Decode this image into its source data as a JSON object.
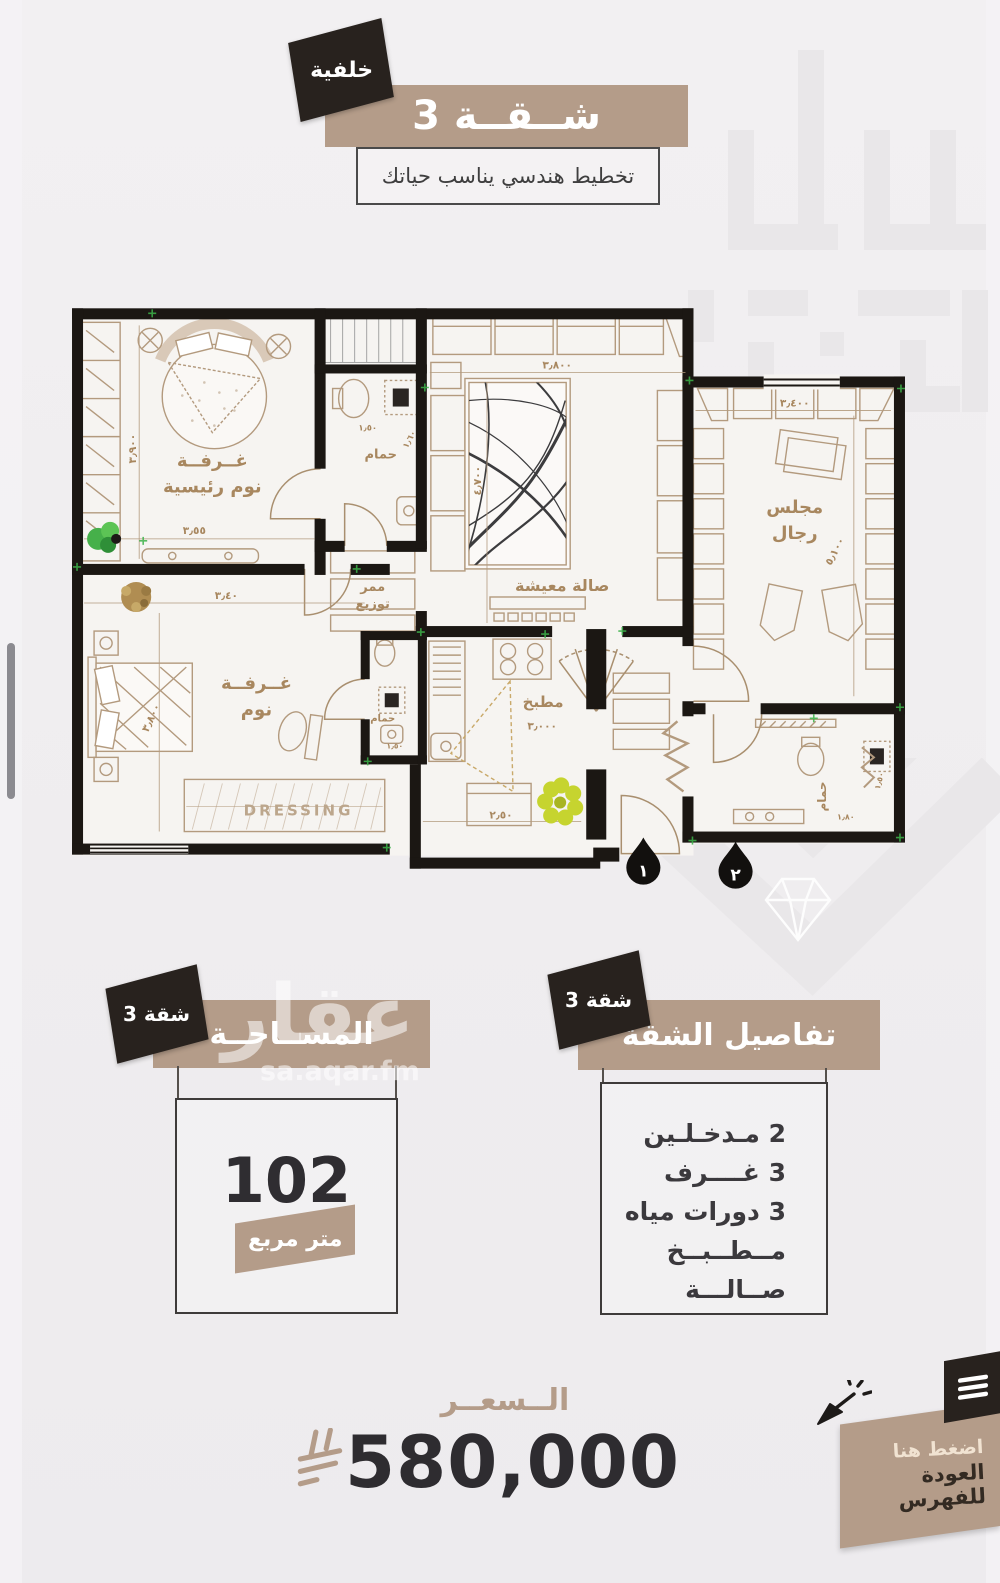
{
  "header": {
    "corner_badge": "خلفية",
    "title": "شــقــة 3",
    "subtitle": "تخطيط هندسي يناسب حياتك"
  },
  "floor_plan": {
    "master": {
      "line1": "غــرفــة",
      "line2": "نوم رئيسية",
      "dim_height": "٣٫٩٠٠",
      "dim_width": "٣٫٥٥"
    },
    "bath_top": {
      "label": "حمام",
      "dim1": "١٫٥٠",
      "dim2": "١٫٦٠"
    },
    "corridor": {
      "line1": "ممر",
      "line2": "توزيع"
    },
    "living": {
      "label": "صالة معيشة",
      "dim_width": "٣٫٨٠٠",
      "dim_height": "٤٫٧٠٠"
    },
    "majlis": {
      "line1": "مجلس",
      "line2": "رجال",
      "dim_width": "٣٫٤٠٠",
      "dim_height": "٥٫١٠٠"
    },
    "bedroom2": {
      "line1": "غــرفــة",
      "line2": "نوم",
      "dim_width": "٣٫٤٠",
      "dim_height": "٣٫٨٠٠"
    },
    "bath_small": {
      "label": "حمام",
      "dim1": "١٫٥٠"
    },
    "kitchen": {
      "label": "مطبخ",
      "dim1": "٣٫٠٠٠",
      "dim2": "٢٫٥٠"
    },
    "bath_guest": {
      "label": "حمام",
      "dim1": "١٫٥٠",
      "dim2": "١٫٨٠"
    },
    "dressing_label": "DRESSING",
    "entrance_1": "١",
    "entrance_2": "٢"
  },
  "area_section": {
    "badge": "شقة 3",
    "title": "المســاحــة",
    "value": "102",
    "unit": "متر مربع"
  },
  "details_section": {
    "badge": "شقة 3",
    "title": "تفاصيل الشقة",
    "items": [
      "2 مـدخـلـين",
      "3 غــــرف",
      "3 دورات مياه",
      "مــطــبــخ",
      "صــالـــة"
    ]
  },
  "price_section": {
    "label": "الــسعــر",
    "value": "580,000",
    "currency_icon": "saudi-riyal-symbol"
  },
  "back_button": {
    "line1": "اضغط هنا",
    "line2": "العودة للفهرس",
    "menu_icon": "hamburger-icon",
    "cursor_icon": "click-cursor-icon"
  },
  "watermark": {
    "brand": "عقار",
    "site": "sa.aqar.fm"
  },
  "colors": {
    "tan": "#b49c89",
    "badge_black": "#28221e",
    "text_dark": "#38363a",
    "plan_wall": "#1b1713",
    "plan_brown": "#b39a7e",
    "label_brown": "#a8875f",
    "accent_green": "#3db34a",
    "flower_green": "#c6d42f"
  }
}
